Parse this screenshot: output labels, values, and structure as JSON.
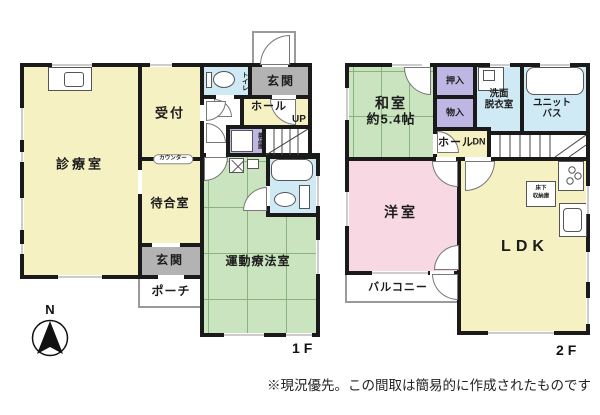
{
  "floor1": {
    "floor_label": "1F",
    "rooms": {
      "clinic_room": "診療室",
      "reception": "受付",
      "counter": "カウンター",
      "waiting_room": "待合室",
      "entrance_clinic": "玄関",
      "entrance_residence": "玄関",
      "porch": "ポーチ",
      "toilet": "トイレ",
      "hall": "ホール",
      "stairs_up": "UP",
      "medicine_storage": "薬品庫",
      "exercise_therapy_room": "運動療法室"
    }
  },
  "floor2": {
    "floor_label": "2F",
    "rooms": {
      "japanese_room": "和室",
      "japanese_room_size": "約5.4帖",
      "closet_oshiire": "押入",
      "storage_monoire": "物入",
      "washroom_line1": "洗面",
      "washroom_line2": "脱衣室",
      "unit_bath_line1": "ユニット",
      "unit_bath_line2": "バス",
      "hall": "ホール",
      "stairs_down": "DN",
      "western_room": "洋室",
      "ldk": "LDK",
      "balcony": "バルコニー",
      "underfloor_line1": "床下",
      "underfloor_line2": "収納庫"
    }
  },
  "compass": {
    "north_label": "N"
  },
  "footnote": "※現況優先。この間取は簡易的に作成されたものです",
  "colors": {
    "room_yellow": "#f6f1c3",
    "room_green": "#c9e4bf",
    "room_pink": "#f8d8e2",
    "room_blue": "#cfeaf5",
    "room_purple": "#beb6e3",
    "room_gray": "#b3b3b3",
    "wall": "#1a1a1a"
  }
}
